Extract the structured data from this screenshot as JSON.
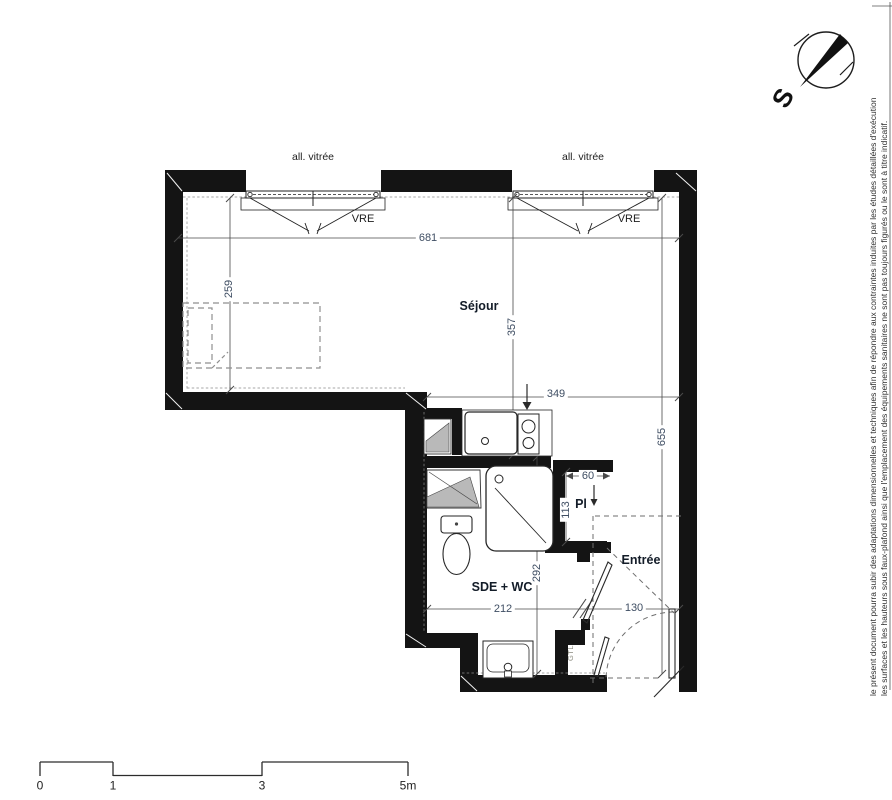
{
  "labels": {
    "room_sejour": "Séjour",
    "room_sde_wc": "SDE + WC",
    "room_closet": "Pl",
    "room_entry": "Entrée",
    "gtl": "GTL",
    "window_top": "all. vitrée",
    "window_shutter": "VRE"
  },
  "dimensions": {
    "d681": "681",
    "d655": "655",
    "d357": "357",
    "d349": "349",
    "d259": "259",
    "d292": "292",
    "d212": "212",
    "d130": "130",
    "d113": "113",
    "d60": "60"
  },
  "scale_bar": {
    "tick_0": "0",
    "tick_1": "1",
    "tick_3": "3",
    "tick_5": "5m"
  },
  "compass": {
    "south": "S"
  },
  "disclaimer": {
    "line_1": "le présent document pourra subir des adaptations dimensionnelles et techniques afin de répondre aux contraintes induites par les études détaillées d'exécution",
    "line_2": "les surfaces et les hauteurs sous faux-plafond ainsi que l'emplacement des équipements sanitaires ne sont pas toujours figurés ou le sont à titre indicatif."
  },
  "colors": {
    "wall": "#141414",
    "dimension_text": "#3f4e63",
    "room_label": "#131c28",
    "line": "#4a4a4a",
    "fixture_gray": "#b9b9b9"
  }
}
